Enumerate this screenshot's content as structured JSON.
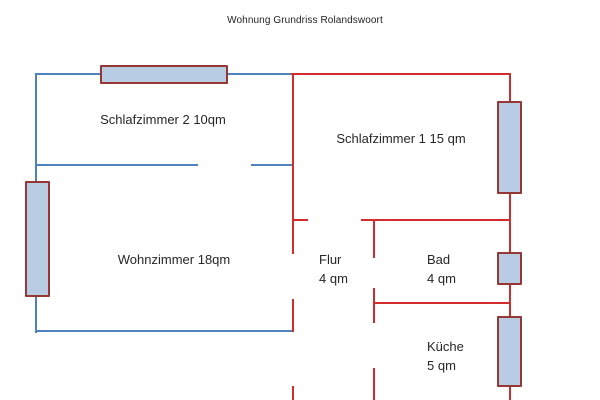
{
  "title": "Wohnung Grundriss Rolandswoort",
  "rooms": {
    "schlafzimmer2": {
      "label": "Schlafzimmer 2 10qm"
    },
    "schlafzimmer1": {
      "label": "Schlafzimmer 1 15 qm"
    },
    "wohnzimmer": {
      "label": "Wohnzimmer 18qm"
    },
    "flur": {
      "name": "Flur",
      "area": "4 qm"
    },
    "bad": {
      "name": "Bad",
      "area": "4 qm"
    },
    "kueche": {
      "name": "Küche",
      "area": "5 qm"
    }
  },
  "colors": {
    "wall_blue": "#4f81bd",
    "wall_red": "#d22c2c",
    "window_fill": "#b8cce4",
    "window_border": "#953735",
    "text": "#262626"
  }
}
